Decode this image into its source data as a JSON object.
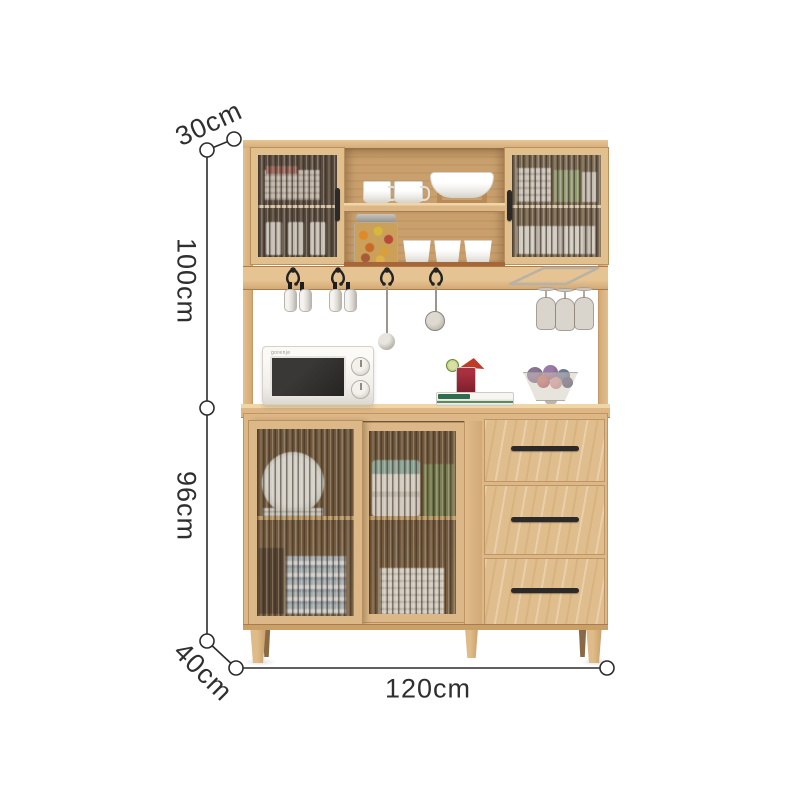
{
  "dimension_labels": {
    "top_depth": "30cm",
    "upper_section_height": "100cm",
    "lower_section_height": "96cm",
    "base_depth": "40cm",
    "total_width": "120cm"
  },
  "appliance": {
    "microwave_brand": "gorenje"
  },
  "palette": {
    "wood": "#dfbc8b",
    "wood_frame": "#e2c08e",
    "wood_dark": "#b58a58",
    "interior_dark": "#6e563c",
    "hardware_black": "#2b2a28",
    "dimension_line": "#2b2b2b",
    "label_text": "#2f2f2f",
    "background": "#ffffff"
  }
}
